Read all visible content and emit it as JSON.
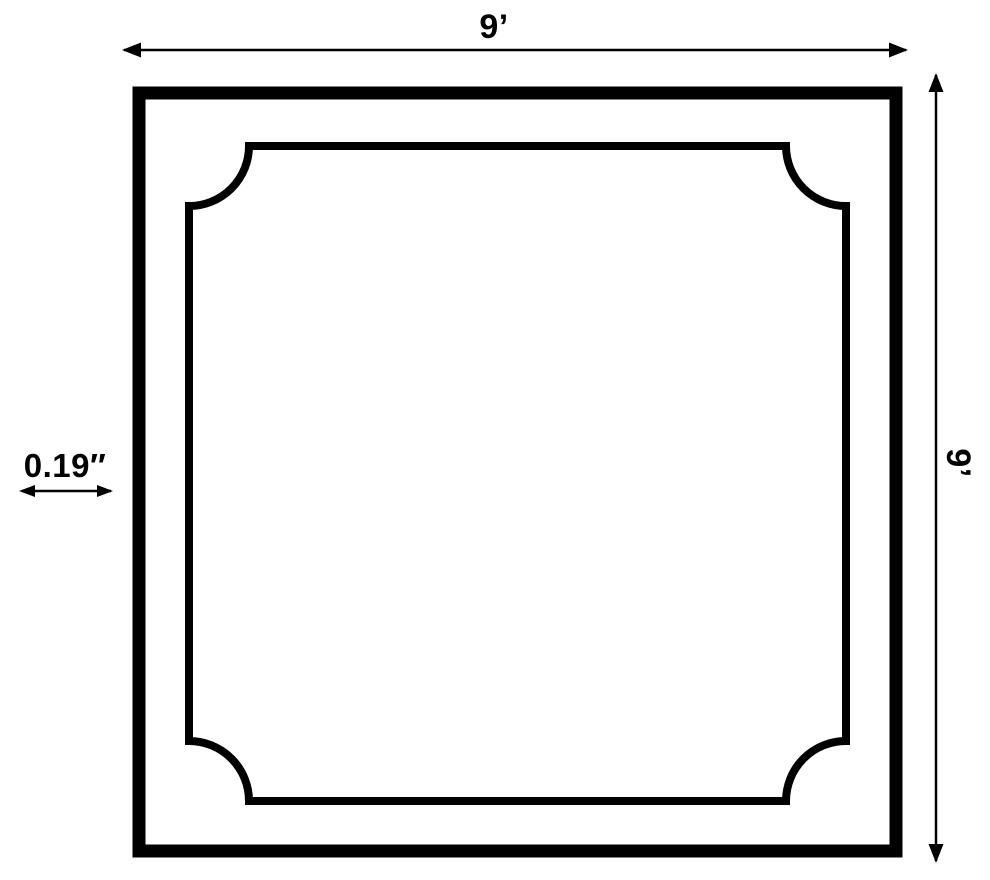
{
  "diagram": {
    "width_dimension": {
      "label": "9’"
    },
    "height_dimension": {
      "label": "9’"
    },
    "thickness_dimension": {
      "label": "0.19″"
    }
  },
  "colors": {
    "line": "#000000",
    "background": "#ffffff"
  }
}
